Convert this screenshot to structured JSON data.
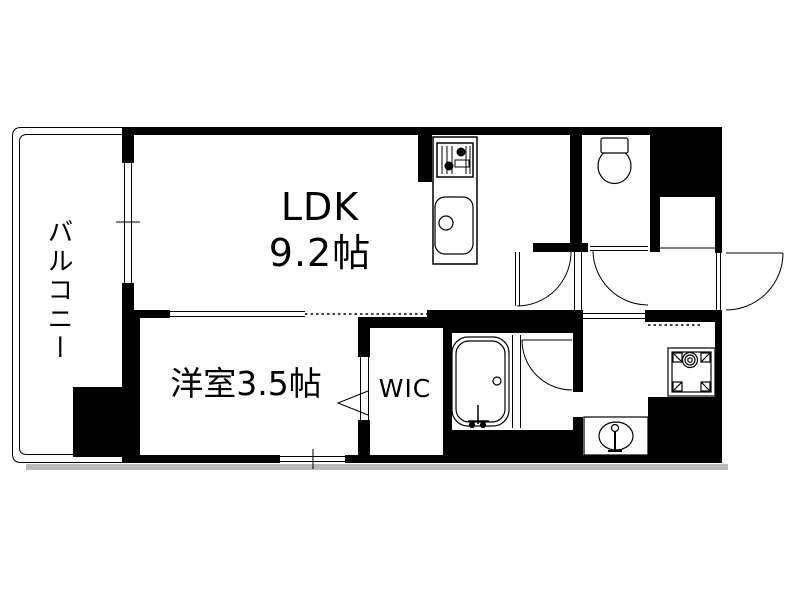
{
  "floorplan": {
    "labels": {
      "balcony": "バルコニー",
      "ldk_name": "LDK",
      "ldk_size": "9.2帖",
      "bedroom": "洋室3.5帖",
      "wic": "WIC"
    },
    "fixtures": [
      "kitchen-stove",
      "kitchen-sink",
      "toilet",
      "bathtub",
      "washbasin",
      "washing-machine-pan"
    ],
    "colors": {
      "wall": "#000000",
      "floor": "#ffffff",
      "line": "#000000",
      "shadow": "#b9b9b9"
    }
  }
}
